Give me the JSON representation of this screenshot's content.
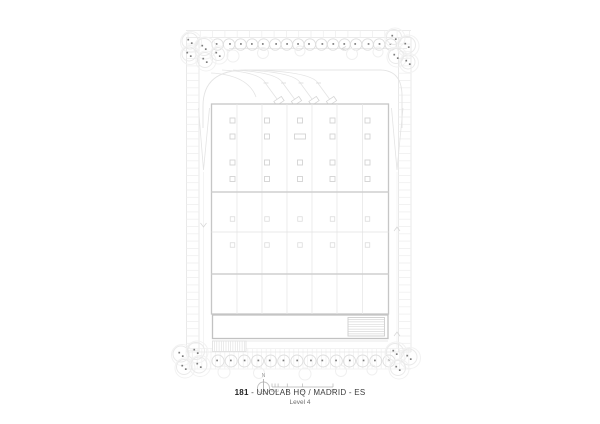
{
  "title": {
    "number": "181",
    "rest": " - UNOLAB HQ / MADRID - ES",
    "level": "Level 4"
  },
  "north": {
    "label": "N"
  },
  "scale_bar": {
    "labels": [
      "0",
      "1",
      "2",
      "5",
      "10",
      "20"
    ]
  },
  "colors": {
    "paper": "#ffffff",
    "line_faint": "#efefef",
    "line_light": "#e4e4e4",
    "line_mid": "#d6d6d6",
    "line_strong": "#c6c6c6",
    "column_stroke": "#d3d3d3",
    "column_stroke_light": "#dcdcdc",
    "tree_stroke": "#dedede",
    "cluster_stroke": "#eaeaea",
    "halo_stroke": "#f2f2f2",
    "vegetation_dot": "#7d7d7d",
    "annotation": "#9a9a9a",
    "annotation_line": "#b5b5b5",
    "title_text": "#3d3d3d",
    "subtitle_text": "#6f6f6f"
  }
}
